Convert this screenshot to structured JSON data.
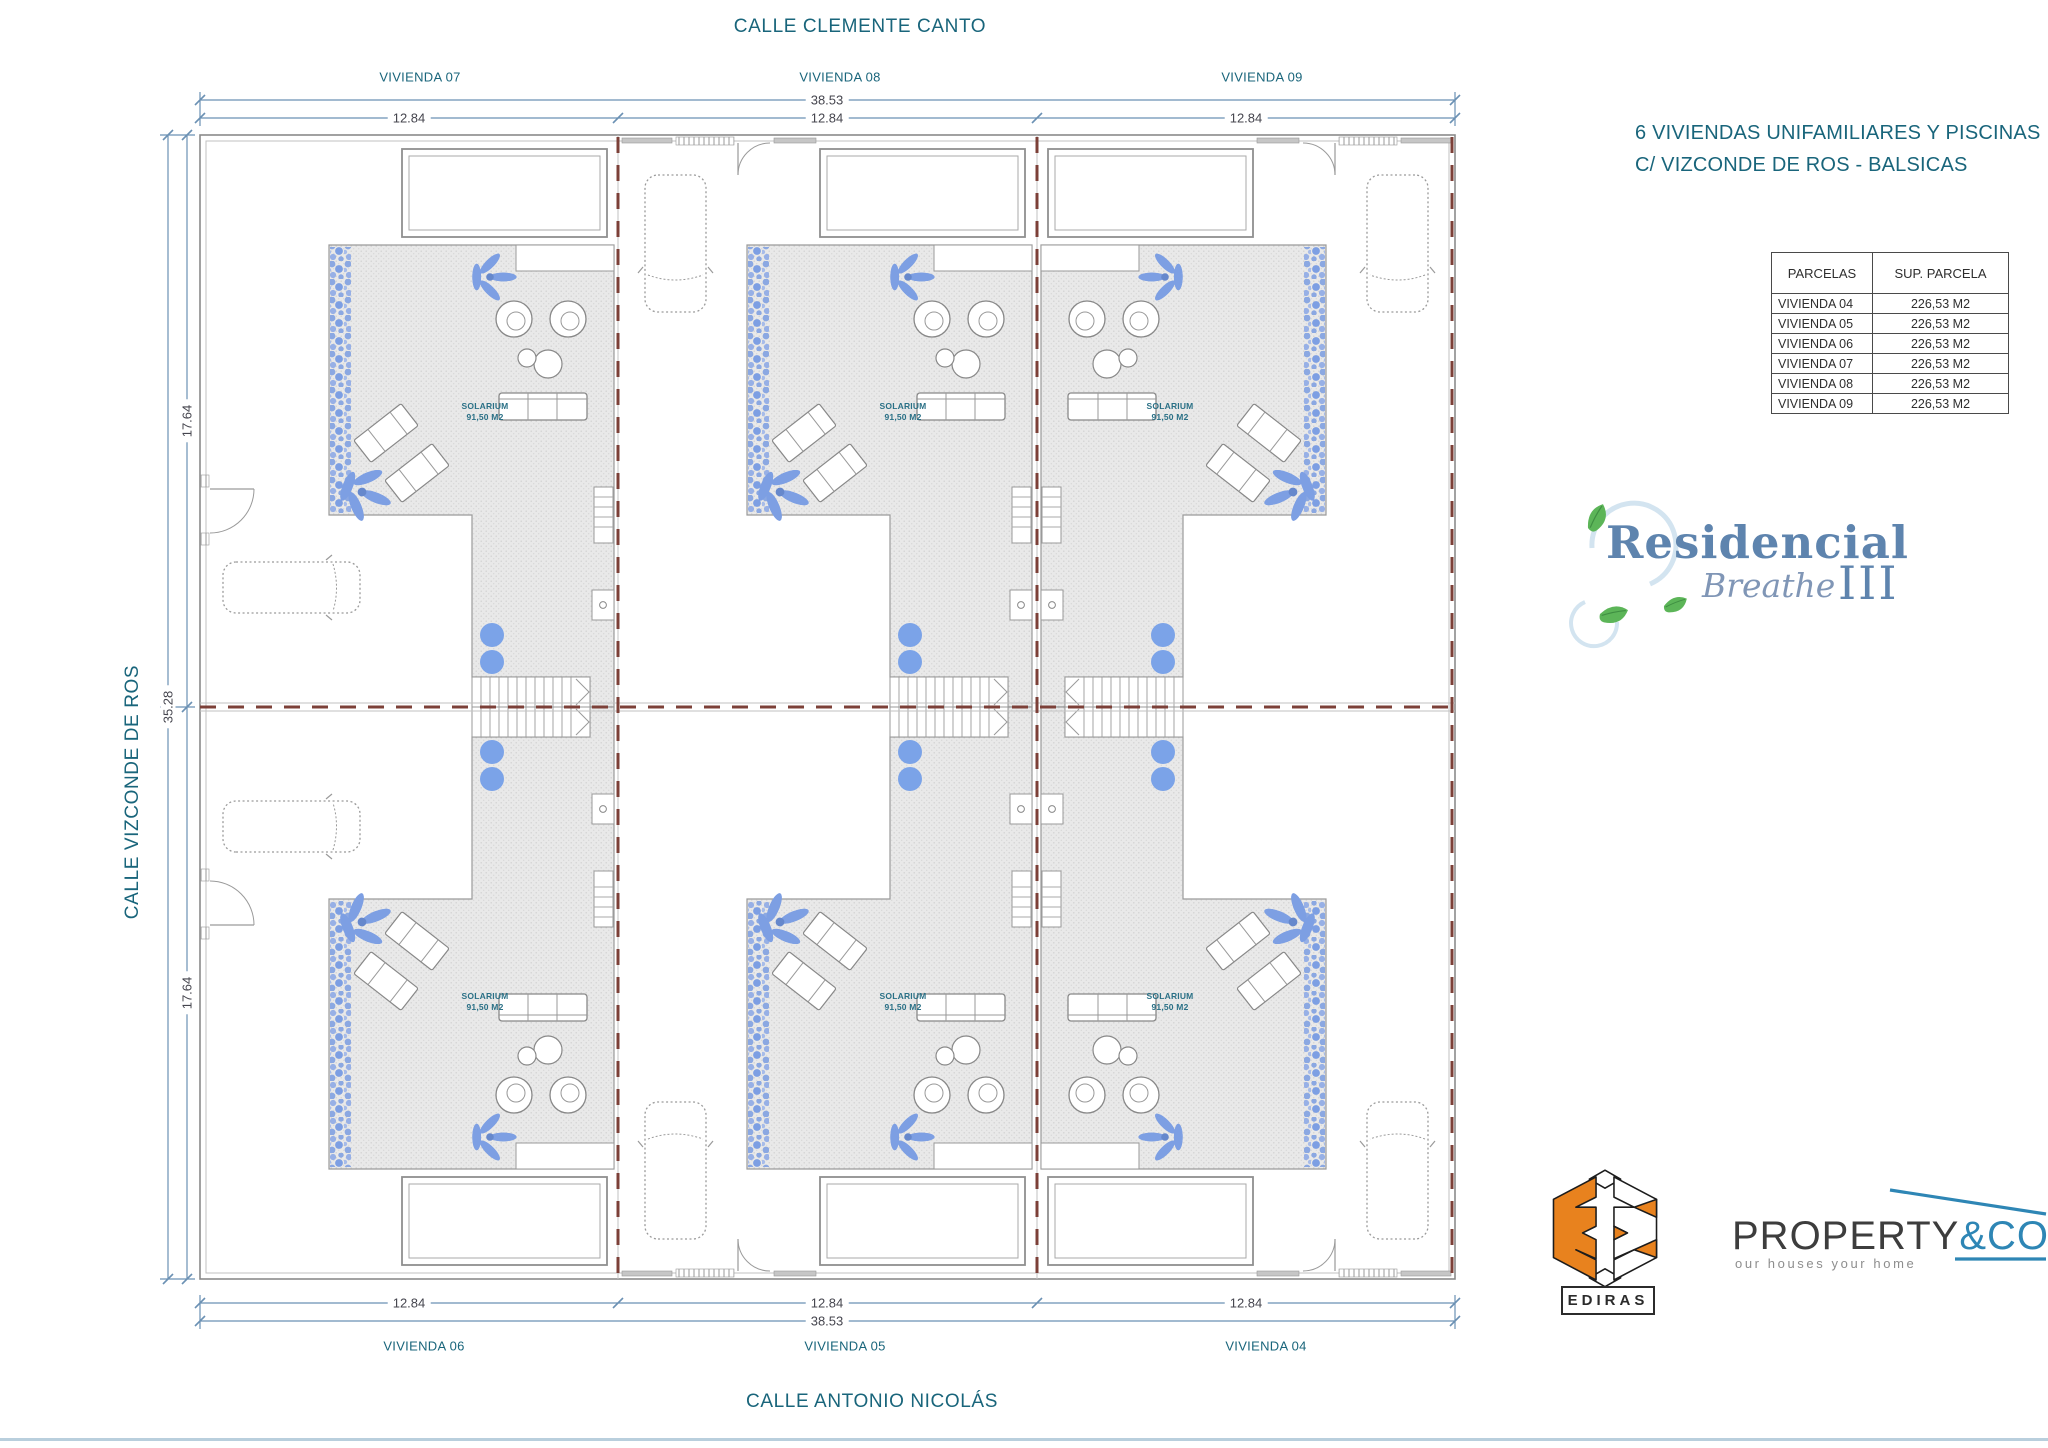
{
  "streets": {
    "top": "CALLE CLEMENTE CANTO",
    "left": "CALLE VIZCONDE DE ROS",
    "bottom": "CALLE ANTONIO NICOLÁS"
  },
  "plan": {
    "top_units": [
      "VIVIENDA 07",
      "VIVIENDA 08",
      "VIVIENDA 09"
    ],
    "bottom_units": [
      "VIVIENDA 06",
      "VIVIENDA 05",
      "VIVIENDA 04"
    ],
    "solarium": {
      "name": "SOLARIUM",
      "area": "91,50 M2"
    },
    "dims": {
      "total_width": "38.53",
      "unit_width": "12.84",
      "half_depth": "17.64",
      "total_depth": "35.28"
    }
  },
  "project": {
    "title_line1": "6 VIVIENDAS UNIFAMILIARES Y PISCINAS",
    "title_line2": "C/ VIZCONDE DE ROS - BALSICAS"
  },
  "parcels_table": {
    "headers": [
      "PARCELAS",
      "SUP. PARCELA"
    ],
    "rows": [
      {
        "parcel": "VIVIENDA 04",
        "area": "226,53 M2"
      },
      {
        "parcel": "VIVIENDA 05",
        "area": "226,53 M2"
      },
      {
        "parcel": "VIVIENDA 06",
        "area": "226,53 M2"
      },
      {
        "parcel": "VIVIENDA 07",
        "area": "226,53 M2"
      },
      {
        "parcel": "VIVIENDA 08",
        "area": "226,53 M2"
      },
      {
        "parcel": "VIVIENDA 09",
        "area": "226,53 M2"
      }
    ]
  },
  "brand": {
    "name": "Residencial",
    "script": "Breathe",
    "numeral": "III"
  },
  "partners": {
    "ediras": "EDIRAS",
    "property_name": "PROPERTY",
    "property_amp": "&CO",
    "property_tagline": "our houses your home"
  },
  "colors": {
    "teal_text": "#19657b",
    "dim_line": "#6b91b4",
    "dim_text": "#45454e",
    "parcel_dash": "#7c4038",
    "solarium_fill": "#e9e9e9",
    "plan_line": "#8f8f8f",
    "vegetation_blue": "#7d9fe3",
    "brand_blue": "#5e84ae",
    "leaf_green": "#5cb558",
    "ediras_orange": "#e8821e",
    "property_dark": "#3d3d3d",
    "property_blue": "#2e86b5"
  }
}
